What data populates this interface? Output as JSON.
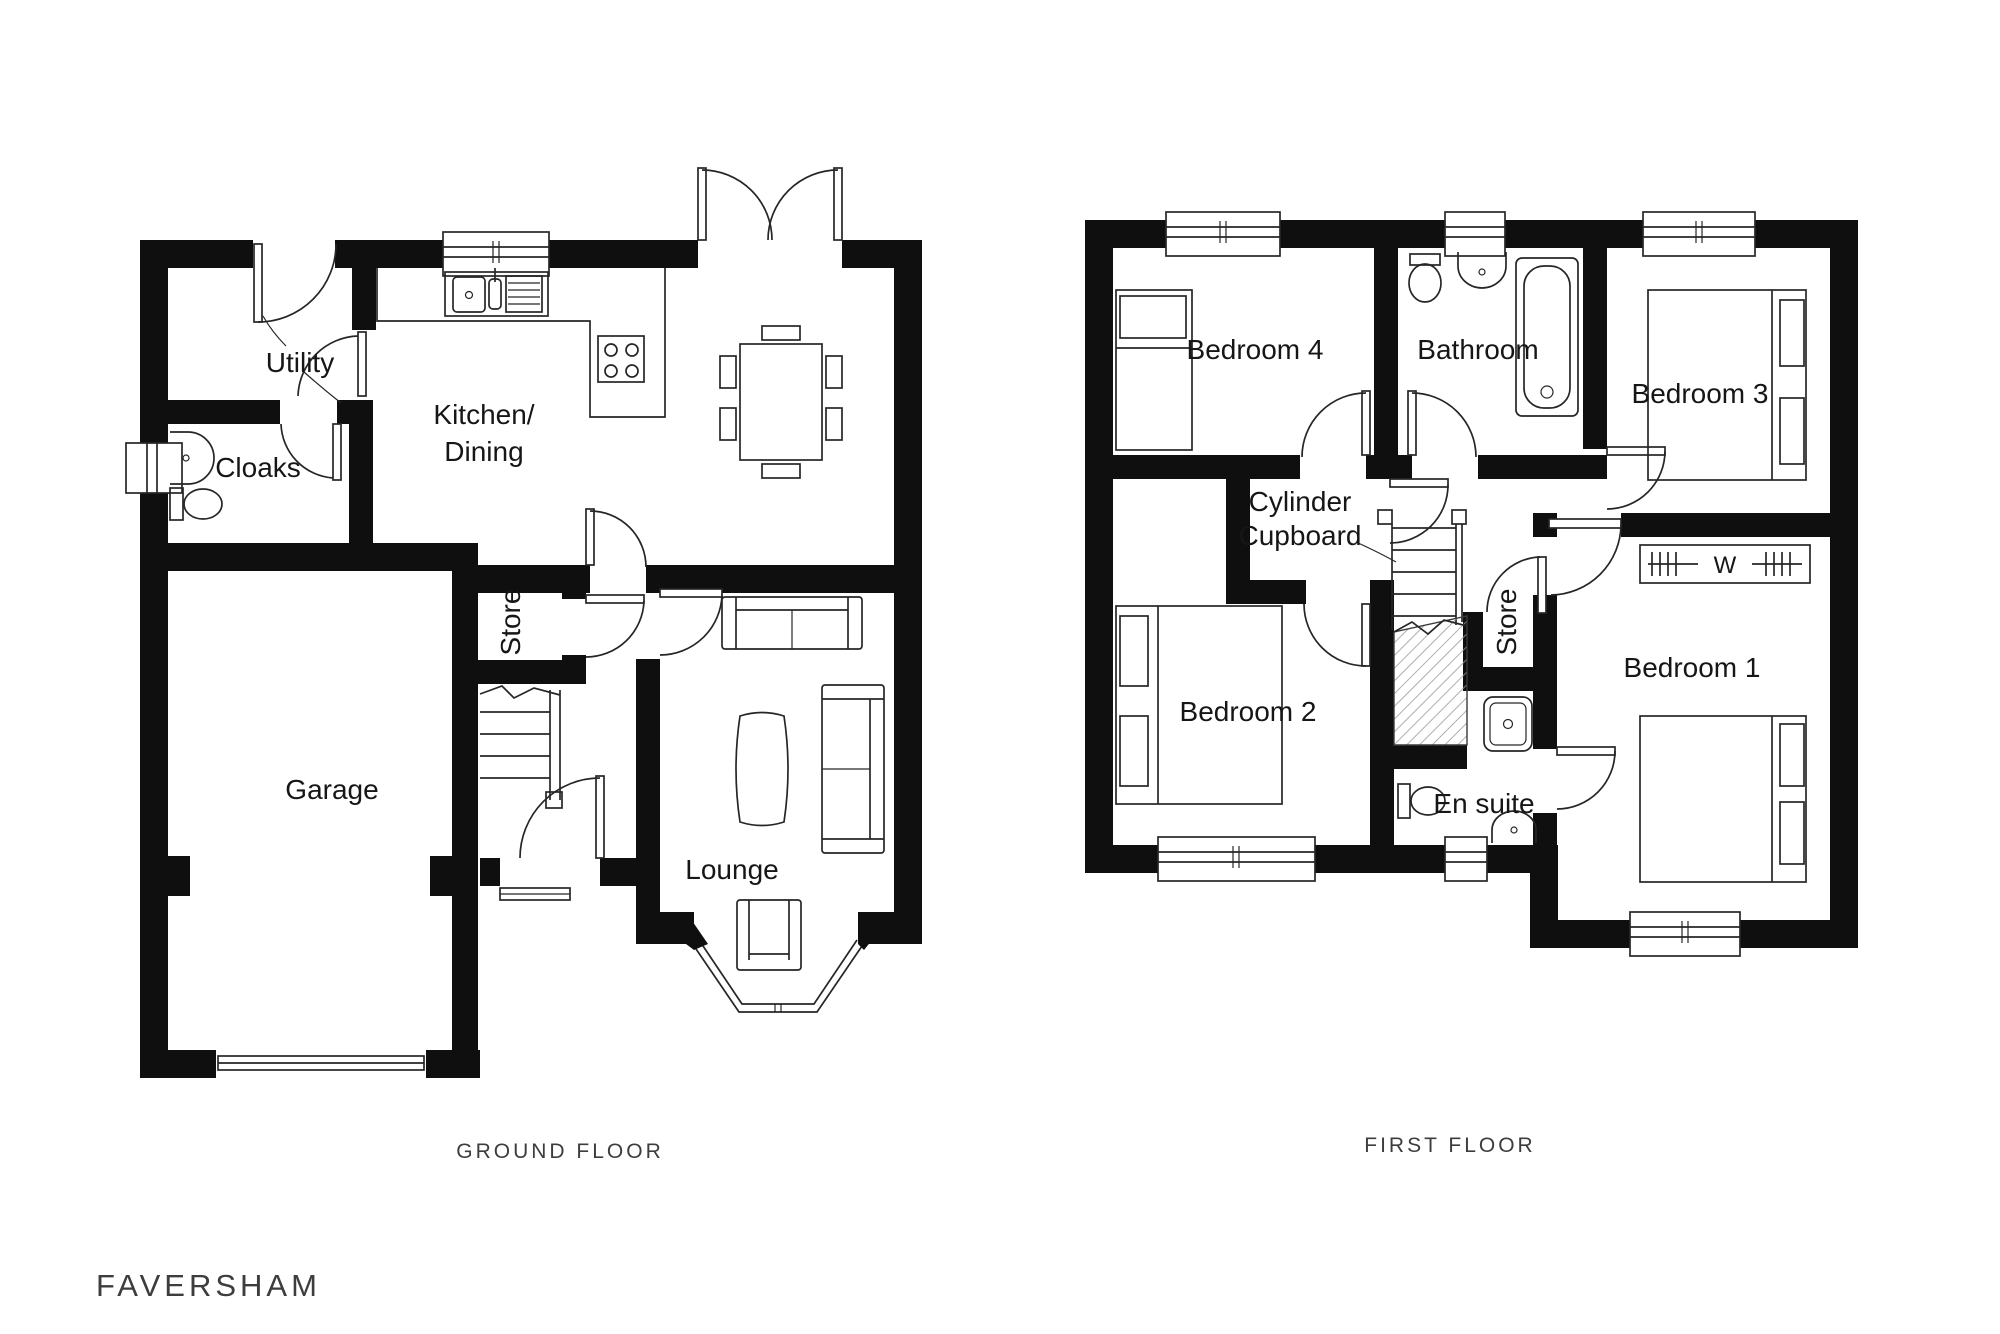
{
  "title": "FAVERSHAM",
  "floors": [
    {
      "caption": "GROUND FLOOR",
      "rooms": {
        "utility": "Utility",
        "cloaks": "Cloaks",
        "kitchen_line1": "Kitchen/",
        "kitchen_line2": "Dining",
        "store": "Store",
        "garage": "Garage",
        "lounge": "Lounge"
      }
    },
    {
      "caption": "FIRST FLOOR",
      "rooms": {
        "bedroom4": "Bedroom 4",
        "bathroom": "Bathroom",
        "bedroom3": "Bedroom 3",
        "cylinder_line1": "Cylinder",
        "cylinder_line2": "Cupboard",
        "bedroom2": "Bedroom 2",
        "store": "Store",
        "ensuite": "En suite",
        "bedroom1": "Bedroom 1",
        "wardrobe": "W"
      }
    }
  ]
}
